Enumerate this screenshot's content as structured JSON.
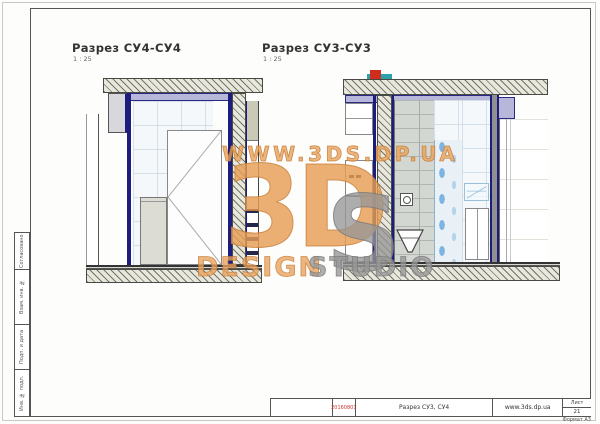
{
  "sheet": {
    "views": [
      {
        "title": "Разрез СУ4-СУ4",
        "scale": "1 : 25"
      },
      {
        "title": "Разрез СУ3-СУ3",
        "scale": "1 : 25"
      }
    ],
    "side_strip": {
      "labels": [
        "Согласовано",
        "Взам. инв. №",
        "Подп. и дата",
        "Инв. № подл."
      ]
    },
    "title_block": {
      "code": "20160801",
      "doc_title": "Разрез СУ3, СУ4",
      "website": "www.3ds.dp.ua",
      "sheet_label": "Лист",
      "sheet_number": "21",
      "format_label": "Формат А3"
    },
    "watermark": {
      "url_line": "WWW.3DS.DP.UA",
      "logo_3d": "3D",
      "logo_s": "S",
      "word_design": "DESIGN",
      "word_studio": "STUDIO"
    },
    "colors": {
      "watermark_orange": "#e8a25c",
      "watermark_grey": "#989898",
      "wall_navy": "#1d1d80",
      "lintel_lavender": "#b7b7d9",
      "mosaic_blue": "#7db5e0",
      "pipe_red": "#cf2d1e",
      "pipe_teal": "#2ea2aa",
      "code_red": "#cc3333"
    }
  }
}
